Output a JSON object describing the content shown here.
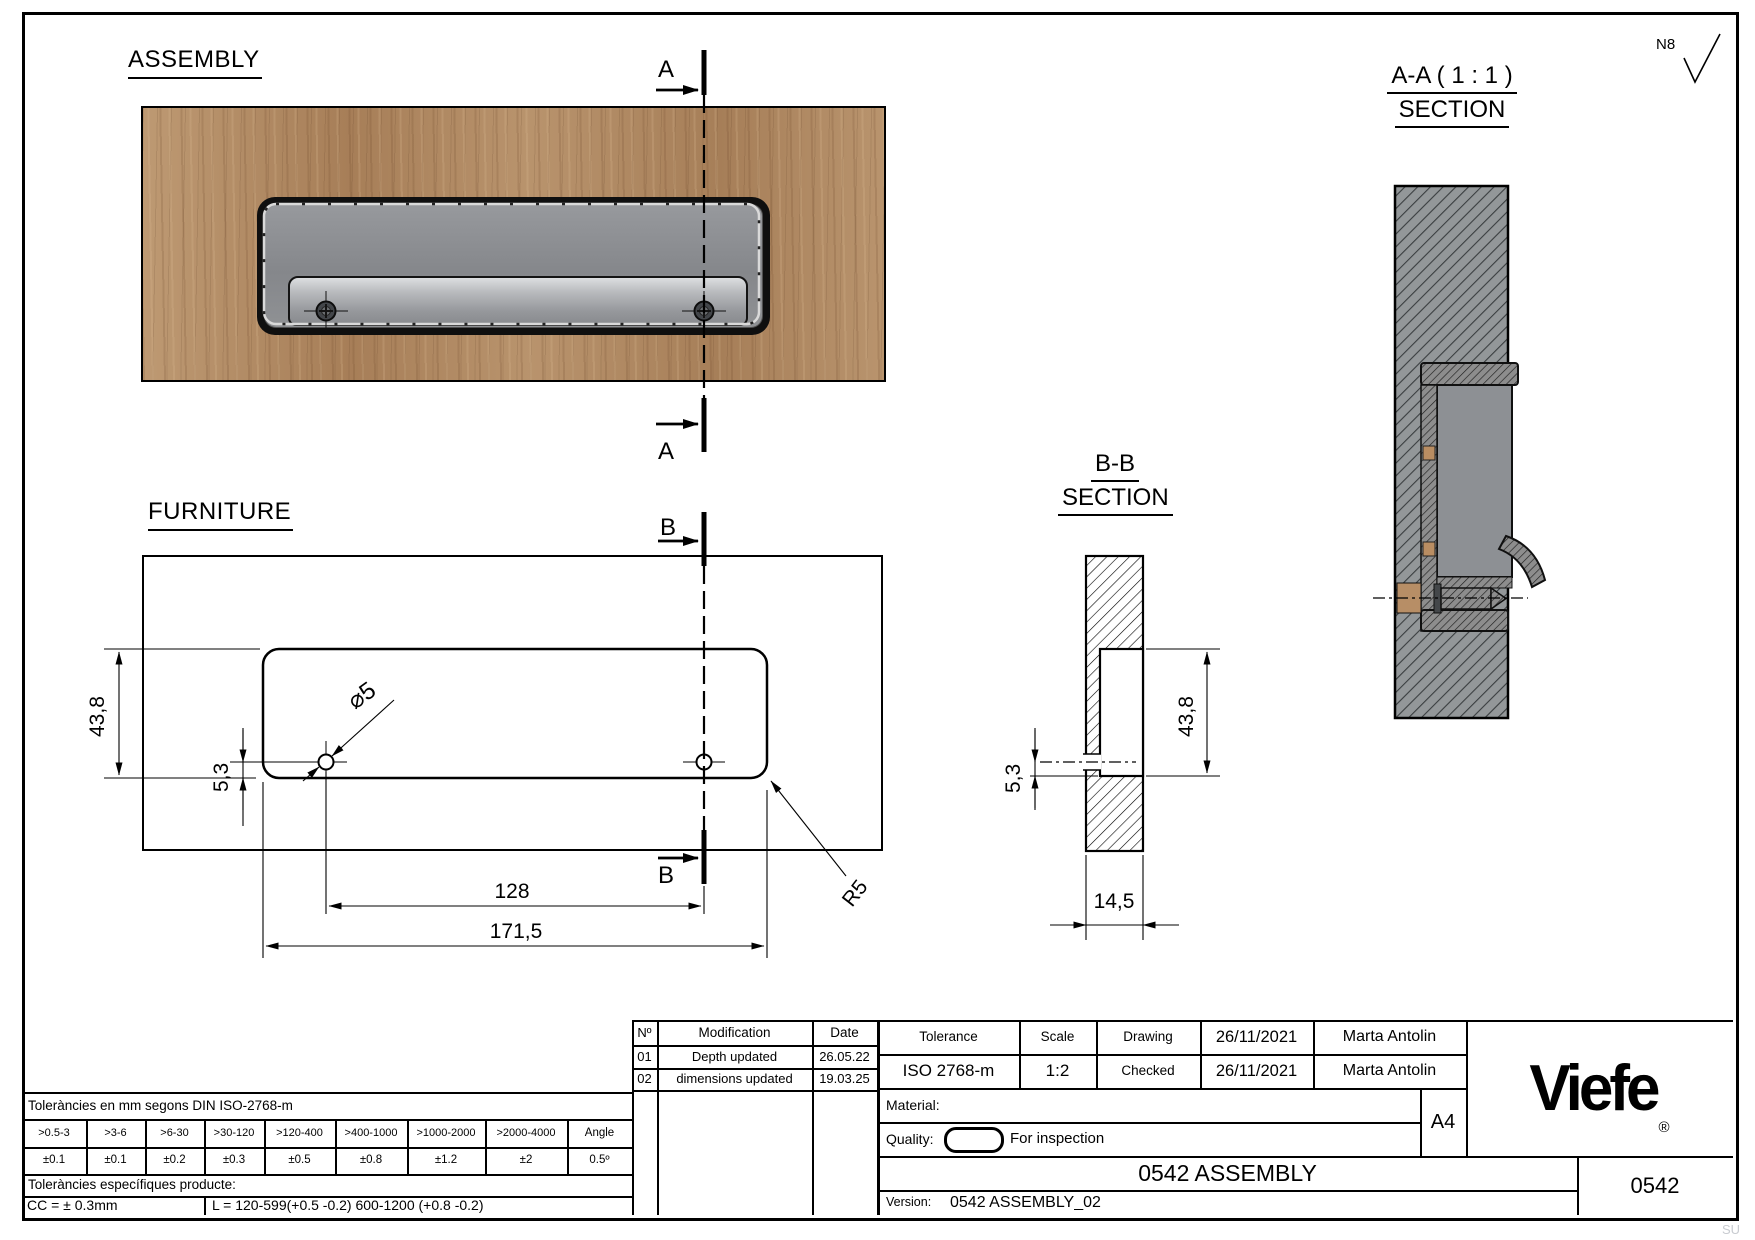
{
  "page": {
    "watermark": "SU"
  },
  "surface_mark": {
    "label": "N8"
  },
  "views": {
    "assembly": {
      "title": "ASSEMBLY",
      "section_letter": "A"
    },
    "furniture": {
      "title": "FURNITURE",
      "section_letter": "B",
      "dims": {
        "height": "43,8",
        "hole_offset": "5,3",
        "hole_dia": "⌀5",
        "hole_spacing": "128",
        "length": "171,5",
        "corner_radius": "R5"
      }
    },
    "section_bb": {
      "title": "B-B",
      "subtitle": "SECTION",
      "dims": {
        "hole_offset": "5,3",
        "height": "43,8",
        "depth": "14,5"
      }
    },
    "section_aa": {
      "title": "A-A ( 1 : 1 )",
      "subtitle": "SECTION"
    }
  },
  "modifications": {
    "headers": [
      "Nº",
      "Modification",
      "Date"
    ],
    "rows": [
      [
        "01",
        "Depth updated",
        "26.05.22"
      ],
      [
        "02",
        "dimensions updated",
        "19.03.25"
      ]
    ]
  },
  "tolerances": {
    "title": "Toleràncies en mm segons DIN ISO-2768-m",
    "ranges": [
      ">0.5-3",
      ">3-6",
      ">6-30",
      ">30-120",
      ">120-400",
      ">400-1000",
      ">1000-2000",
      ">2000-4000",
      "Angle"
    ],
    "values": [
      "±0.1",
      "±0.1",
      "±0.2",
      "±0.3",
      "±0.5",
      "±0.8",
      "±1.2",
      "±2",
      "0.5º"
    ],
    "specific_title": "Toleràncies específiques producte:",
    "cc": "CC = ± 0.3mm",
    "l": "L = 120-599(+0.5 -0.2) 600-1200 (+0.8 -0.2)"
  },
  "title_block": {
    "tolerance_label": "Tolerance",
    "tolerance_value": "ISO 2768-m",
    "scale_label": "Scale",
    "scale_value": "1:2",
    "drawing_label": "Drawing",
    "drawing_date": "26/11/2021",
    "drawing_by": "Marta Antolin",
    "checked_label": "Checked",
    "checked_date": "26/11/2021",
    "checked_by": "Marta Antolin",
    "material_label": "Material:",
    "quality_label": "Quality:",
    "quality_value": "For inspection",
    "paper_size": "A4",
    "title": "0542 ASSEMBLY",
    "version_label": "Version:",
    "version_value": "0542 ASSEMBLY_02",
    "code": "0542",
    "brand": "Viefe",
    "registered": "®"
  },
  "colors": {
    "wood": "#b18a63",
    "recess_gray": "#8b8e92",
    "line": "#000000"
  }
}
